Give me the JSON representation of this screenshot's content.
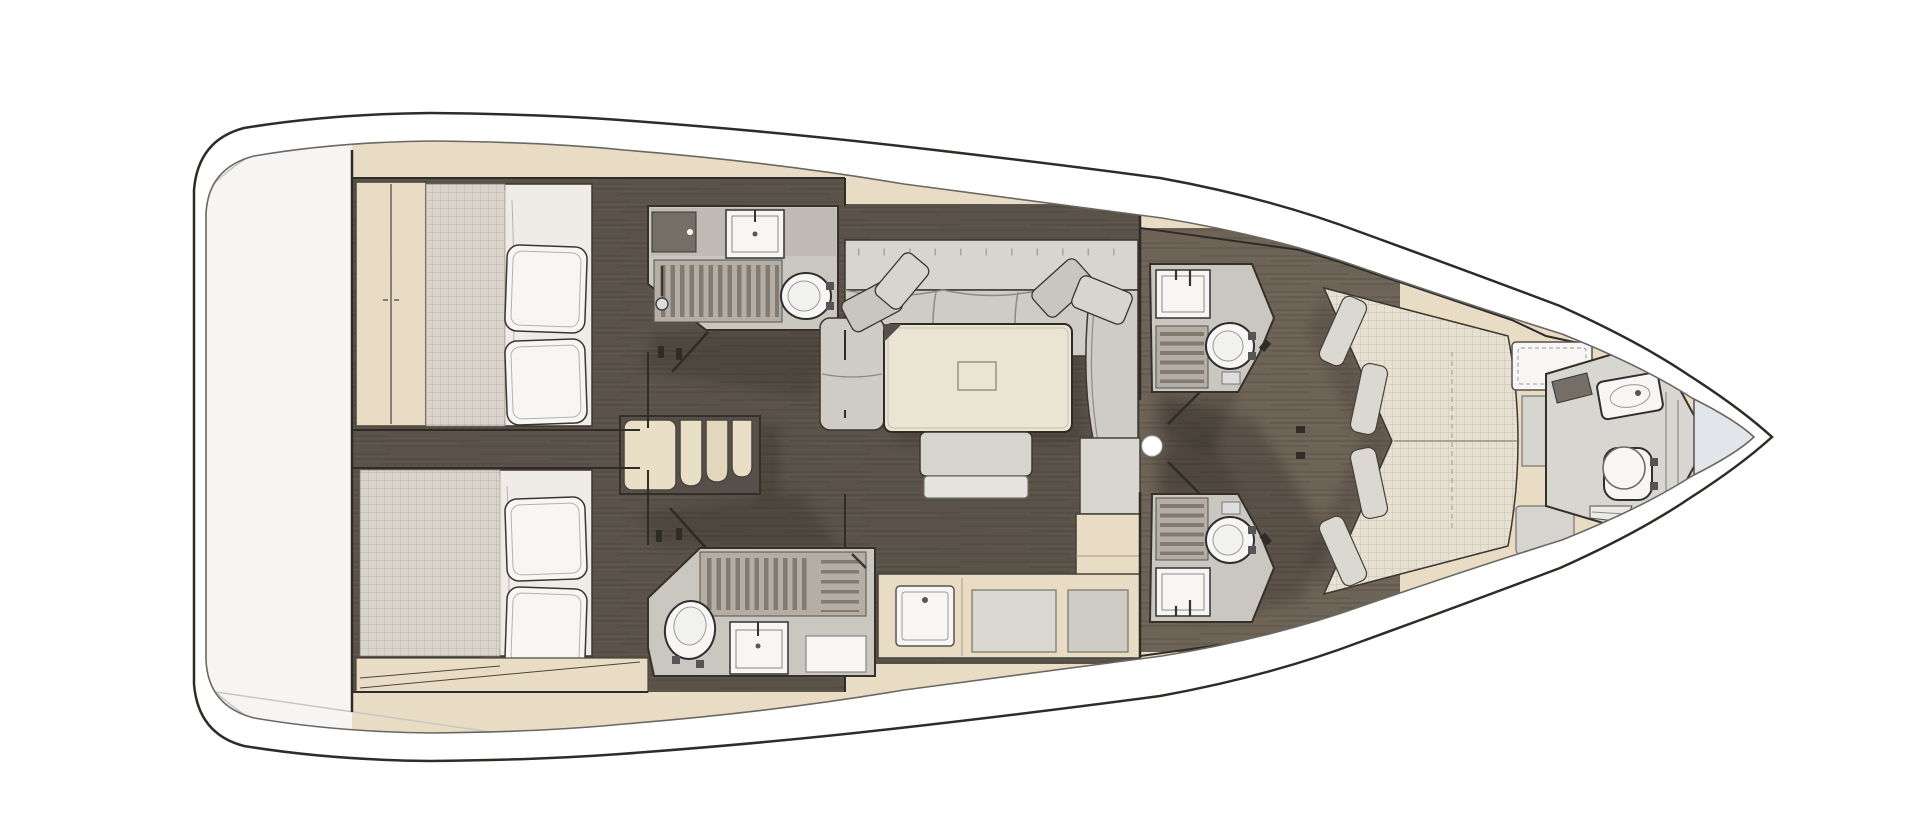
{
  "page": {
    "description": "Top-down interior floor plan of a sailing yacht, bow pointing right, stern platform at left, no visible text labels"
  },
  "colors": {
    "outline": "#2f2c28",
    "inner_line": "#6b6762",
    "tan": "#e8dcc4",
    "tan_dark": "#d9cbad",
    "deck_white": "#f6f5f3",
    "floor_aft": "#5b5349",
    "floor_fwd": "#6e6357",
    "head_floor": "#cac7c1",
    "head_counter": "#bfbbb4",
    "grate_base": "#b4aea5",
    "grate_bar": "#827b71",
    "sofa_back": "#d8d5cf",
    "sofa_seat": "#cfccc5",
    "cushion": "#c9c6bf",
    "table_wood": "#eae4d3",
    "bed_white": "#efece7",
    "mattress": "#d9d5cd",
    "fwd_bed": "#e7e1d3",
    "fixture_white": "#f7f6f4",
    "locker_blue": "#e2e5ea",
    "stair_tread": "#e9dfc6",
    "stair_frame": "#57504a",
    "dark_fitting": "#746e66"
  },
  "vessel": {
    "orientation": {
      "bow": "right",
      "stern": "left"
    },
    "rooms": [
      {
        "id": "stern-platform",
        "type": "transom",
        "fixtures": []
      },
      {
        "id": "aft-cabin-port",
        "type": "cabin",
        "fixtures": [
          "double-bed",
          "two-pillows",
          "wardrobe"
        ]
      },
      {
        "id": "aft-cabin-starboard",
        "type": "cabin",
        "fixtures": [
          "double-bed",
          "two-pillows",
          "locker-band"
        ]
      },
      {
        "id": "aft-head-port",
        "type": "bathroom",
        "fixtures": [
          "vanity-cabinet",
          "sink",
          "shower-grate",
          "toilet",
          "door"
        ]
      },
      {
        "id": "aft-head-starboard",
        "type": "bathroom",
        "fixtures": [
          "toilet",
          "sink",
          "shower-grate",
          "shelf",
          "door"
        ]
      },
      {
        "id": "companionway",
        "type": "stairs",
        "steps": 4
      },
      {
        "id": "salon",
        "type": "saloon",
        "fixtures": [
          "l-shaped-sofa",
          "four-pillows",
          "dining-table",
          "table-hatch",
          "bench",
          "chaise-seat"
        ]
      },
      {
        "id": "galley",
        "type": "galley",
        "fixtures": [
          "l-counter",
          "sink",
          "worktop",
          "appliance"
        ]
      },
      {
        "id": "fwd-head-port",
        "type": "bathroom",
        "fixtures": [
          "sink",
          "shower-grate",
          "toilet",
          "door"
        ]
      },
      {
        "id": "fwd-head-starboard",
        "type": "bathroom",
        "fixtures": [
          "sink",
          "shower-grate",
          "toilet",
          "door"
        ]
      },
      {
        "id": "owner-cabin",
        "type": "cabin",
        "fixtures": [
          "v-berth-double-bed",
          "foot-cushions",
          "deck-hatch",
          "side-lockers"
        ]
      },
      {
        "id": "bow-head",
        "type": "bathroom",
        "fixtures": [
          "console",
          "washbasin",
          "toilet",
          "steps",
          "glass-partition"
        ]
      },
      {
        "id": "anchor-locker",
        "type": "bow-locker",
        "fixtures": []
      }
    ],
    "details": {
      "door_handle_dot": {
        "x": 1152,
        "y": 446
      }
    }
  }
}
